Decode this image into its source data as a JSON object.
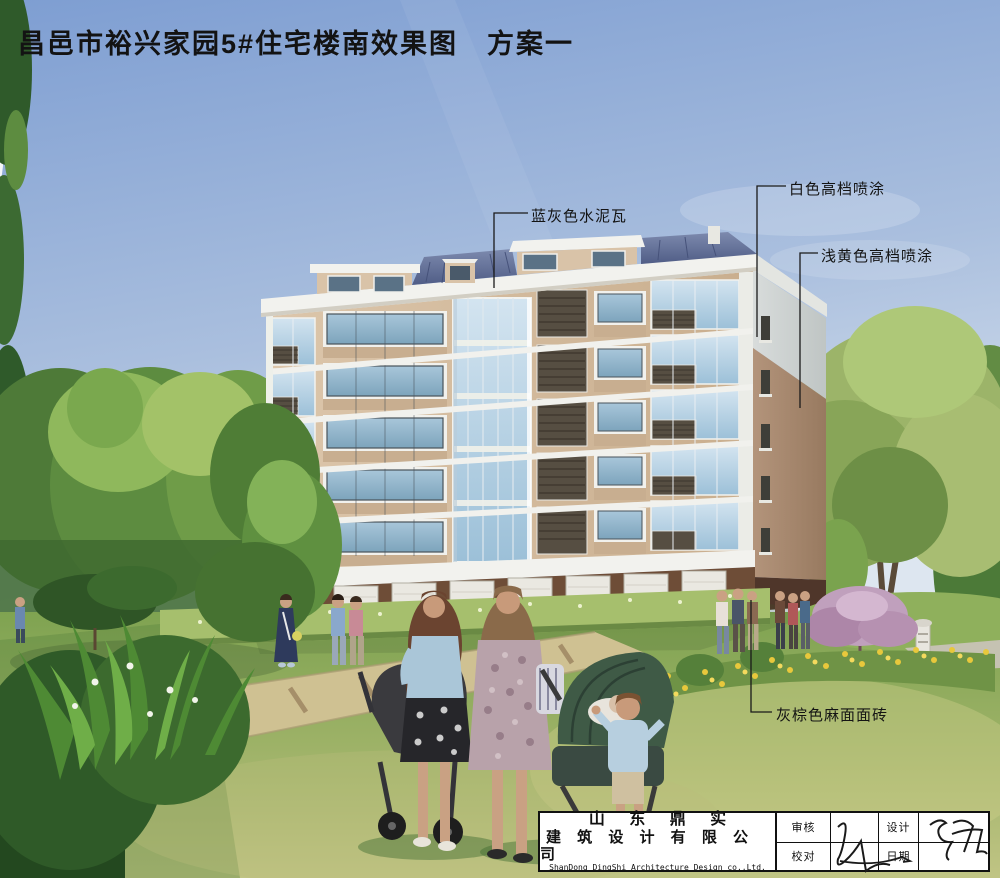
{
  "page_title": "昌邑市裕兴家园5#住宅楼南效果图　方案一",
  "callouts": {
    "roof": "蓝灰色水泥瓦",
    "white_paint": "白色高档喷涂",
    "yellow_paint": "浅黄色高档喷涂",
    "base_tile": "灰棕色麻面面砖"
  },
  "title_block": {
    "company_cn_1": "山 东 鼎 实",
    "company_cn_2": "建 筑 设 计 有 限 公 司",
    "company_en": "ShanDong DingShi Architecture Design co.,Ltd.",
    "review_label": "审核",
    "proofread_label": "校对",
    "design_label": "设计",
    "date_label": "日期"
  },
  "colors": {
    "sky_top": "#7e9ed2",
    "wall_tan": "#d6bfa4",
    "wall_side_shade": "#ab8b70",
    "trim_white": "#f2f2ee",
    "roof_blue_gray": "#6a77a0",
    "base_brown": "#6e4d37",
    "glass_blue": "#b9d3e6",
    "grass_green": "#85a855",
    "flower_yellow": "#e8c83c",
    "title_text": "#131313"
  }
}
